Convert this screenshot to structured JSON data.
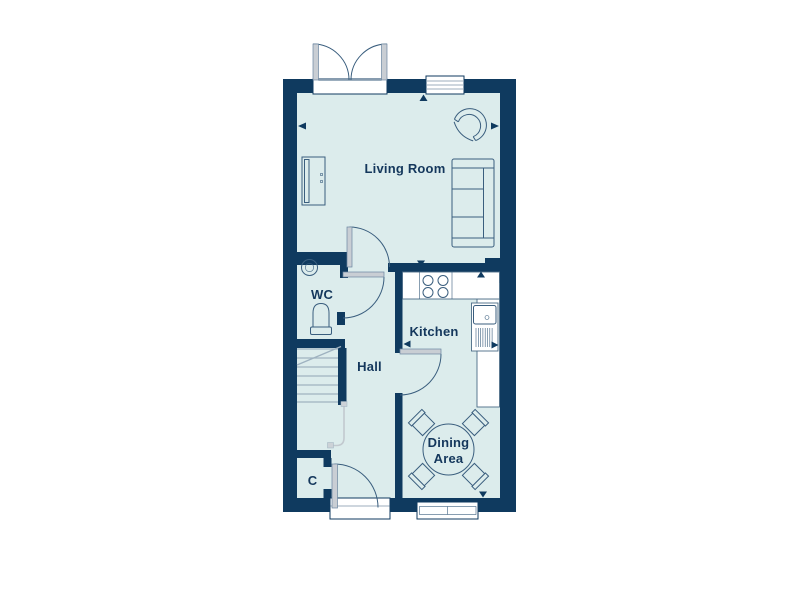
{
  "page": {
    "background": "#ffffff"
  },
  "plan": {
    "type": "ground-floor-plan",
    "colors": {
      "wall": "#0f3a5f",
      "floor": "#dcecec",
      "outline": "#3a5e7e",
      "label_text": "#14375c",
      "door_leaf": "#c9ced4",
      "stair_tread": "#9eb2c0",
      "rail": "#c2c9cf",
      "fixture_bg": "#ffffff"
    },
    "rooms": [
      {
        "name": "living-room",
        "label": "Living Room"
      },
      {
        "name": "wc",
        "label": "WC"
      },
      {
        "name": "hall",
        "label": "Hall"
      },
      {
        "name": "kitchen",
        "label": "Kitchen"
      },
      {
        "name": "dining-area",
        "label": "Dining Area",
        "label_lines": [
          "Dining",
          "Area"
        ]
      },
      {
        "name": "cupboard",
        "label": "C"
      }
    ],
    "fixtures": [
      "french-doors-icon",
      "window-icon",
      "front-door-icon",
      "internal-door-icon",
      "tv-unit-icon",
      "armchair-icon",
      "sofa-icon",
      "basin-icon",
      "toilet-icon",
      "stairs-icon",
      "under-stair-rail-icon",
      "worktop-icon",
      "hob-icon",
      "kitchen-sink-icon",
      "dining-table-icon",
      "dining-chair-icon",
      "dimension-arrow-icon"
    ]
  }
}
